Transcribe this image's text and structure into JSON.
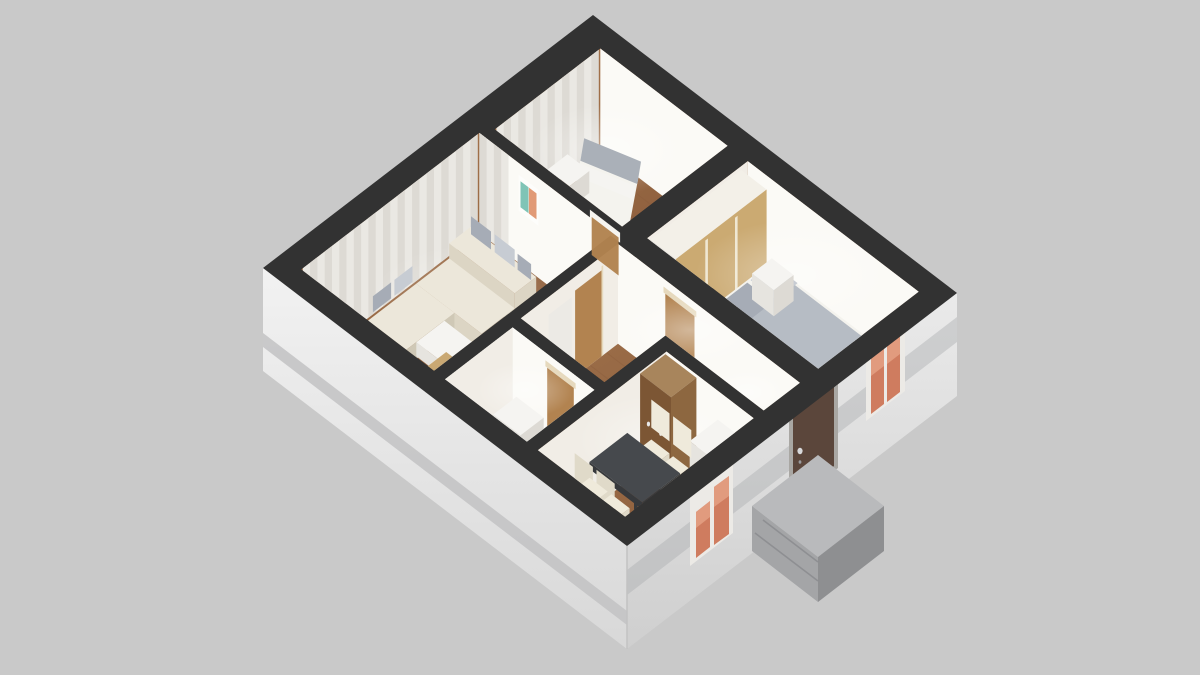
{
  "meta": {
    "type": "3d-floorplan-cutaway-render",
    "description": "Isometric dollhouse cutaway render of a furnished two-bedroom apartment on a plain gray background"
  },
  "scene": {
    "background": "#c9c9c9",
    "rooms": [
      {
        "id": "living-room",
        "label": "Living room"
      },
      {
        "id": "bedroom-small",
        "label": "Small bedroom"
      },
      {
        "id": "bedroom-main",
        "label": "Main bedroom"
      },
      {
        "id": "bathroom",
        "label": "Bathroom"
      },
      {
        "id": "kitchen-dining",
        "label": "Kitchen / dining room"
      },
      {
        "id": "hallway",
        "label": "Hallway"
      }
    ],
    "objects": [
      "corner-sofa",
      "sofa-pillows",
      "ottoman",
      "coffee-table",
      "picture-frame",
      "curtains",
      "single-bed",
      "double-bed",
      "nightstand",
      "wardrobe-sliding-doors",
      "bathtub-glass",
      "washing-machine",
      "dining-table",
      "dining-chairs",
      "tall-cabinet",
      "refrigerator",
      "interior-doors",
      "entrance-door",
      "concrete-steps",
      "facade-windows"
    ],
    "colors": {
      "bg": "#c9c9c9",
      "wallTop": "#323232",
      "facadeSW1": "#f2f2f2",
      "facadeSW2": "#d8d8d8",
      "facadeSE1": "#eaeaea",
      "facadeSE2": "#cfcfcf",
      "plinthSW": "#c2c2c3",
      "bandSE": "#aeafb1",
      "facadeEdge": "#c2c2c2",
      "stepsTop": "#b9babc",
      "stepsFront": "#8e8f91",
      "stepsSide": "#a4a5a7",
      "stepEdge": "#85868a",
      "doorEntry": "#5b463b",
      "doorEntryFrame": "#a9a7a3",
      "handle": "#d8d9db",
      "keyhole": "#9a9b9d",
      "winFrame": "#eceae6",
      "winPane": "#cf7c5f",
      "winPaneLight": "#e8a88b",
      "wood1": "#a9784f",
      "wood2": "#8a5c3b",
      "woodHall": "#a87a52",
      "bathFloor": "#e9e7e1",
      "bathFloorTint": "#dfe7e2",
      "faceN": "#fbfaf6",
      "faceW": "#f1ede6",
      "curtain": "#eae8e3",
      "curtainStripe": "#d9d6d0",
      "oakDoor": "#b28350",
      "oakFrame": "#e6d9bd",
      "wardrobe": "#cbaa72",
      "wardrobeLine": "#efe7d2",
      "wardrobeTop": "#f3f0e8",
      "cabinetTop": "#a8855c",
      "cabinetFront": "#7c5634",
      "cabinetSide": "#8d6740",
      "sofa": "#ece7da",
      "sofaShade": "#dcd5c4",
      "sofaDark": "#cfc8b6",
      "pillow": "#a6acb6",
      "pillowLight": "#c7ccd3",
      "bedTop": "#f4f3ee",
      "bedSide": "#e2dfd7",
      "bedEnd": "#d9d6cd",
      "blanket": "#b6bcc4",
      "bedPad": "#aab0b8",
      "white": "#f5f4f1",
      "whiteShade": "#e6e4df",
      "whiteSide": "#dddad4",
      "tableTop": "#46494d",
      "tableSide": "#37393c",
      "chair": "#efeadb",
      "chairShade": "#e0dac9",
      "tubGlass": "#cfdfd6",
      "tubGlassLight": "#dde9e2",
      "artTeal": "#7fc4b6",
      "artOrange": "#e19a76",
      "artFrame": "#fdfdfb",
      "mirror": "#eceae5",
      "glow": "#ffffff"
    }
  }
}
